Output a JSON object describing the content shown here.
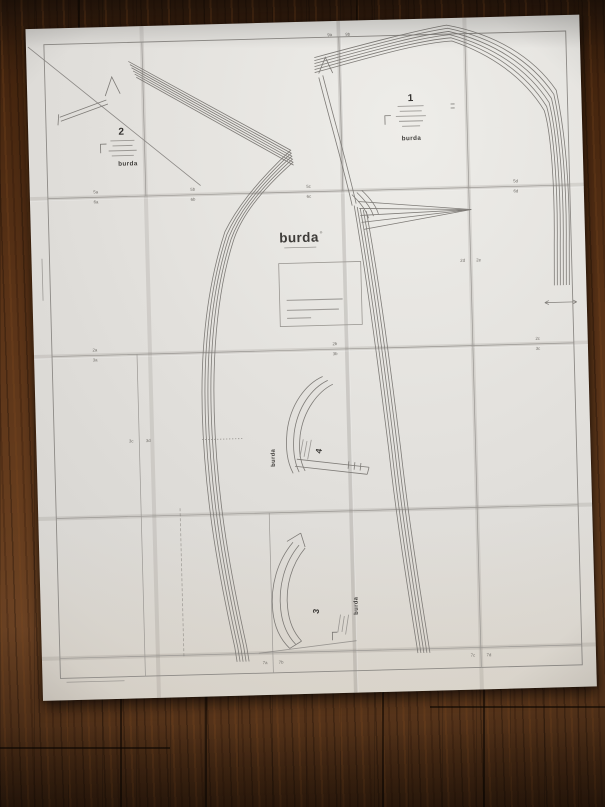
{
  "brand": {
    "logo": "burda",
    "mark": "®"
  },
  "center": {
    "logo": "burda"
  },
  "pieces": {
    "p1": {
      "number": "1",
      "brand": "burda"
    },
    "p2": {
      "number": "2",
      "brand": "burda"
    },
    "p3": {
      "number": "3",
      "brand": "burda"
    },
    "p4": {
      "number": "4",
      "brand": "burda"
    }
  },
  "section_labels": [
    "9a",
    "9b",
    "5a",
    "6a",
    "5b",
    "6b",
    "5c",
    "6c",
    "5d",
    "6d",
    "2d",
    "2e",
    "2a",
    "3a",
    "2b",
    "3b",
    "2c",
    "3c",
    "3c",
    "3d",
    "7a",
    "7b",
    "7c",
    "7d"
  ]
}
